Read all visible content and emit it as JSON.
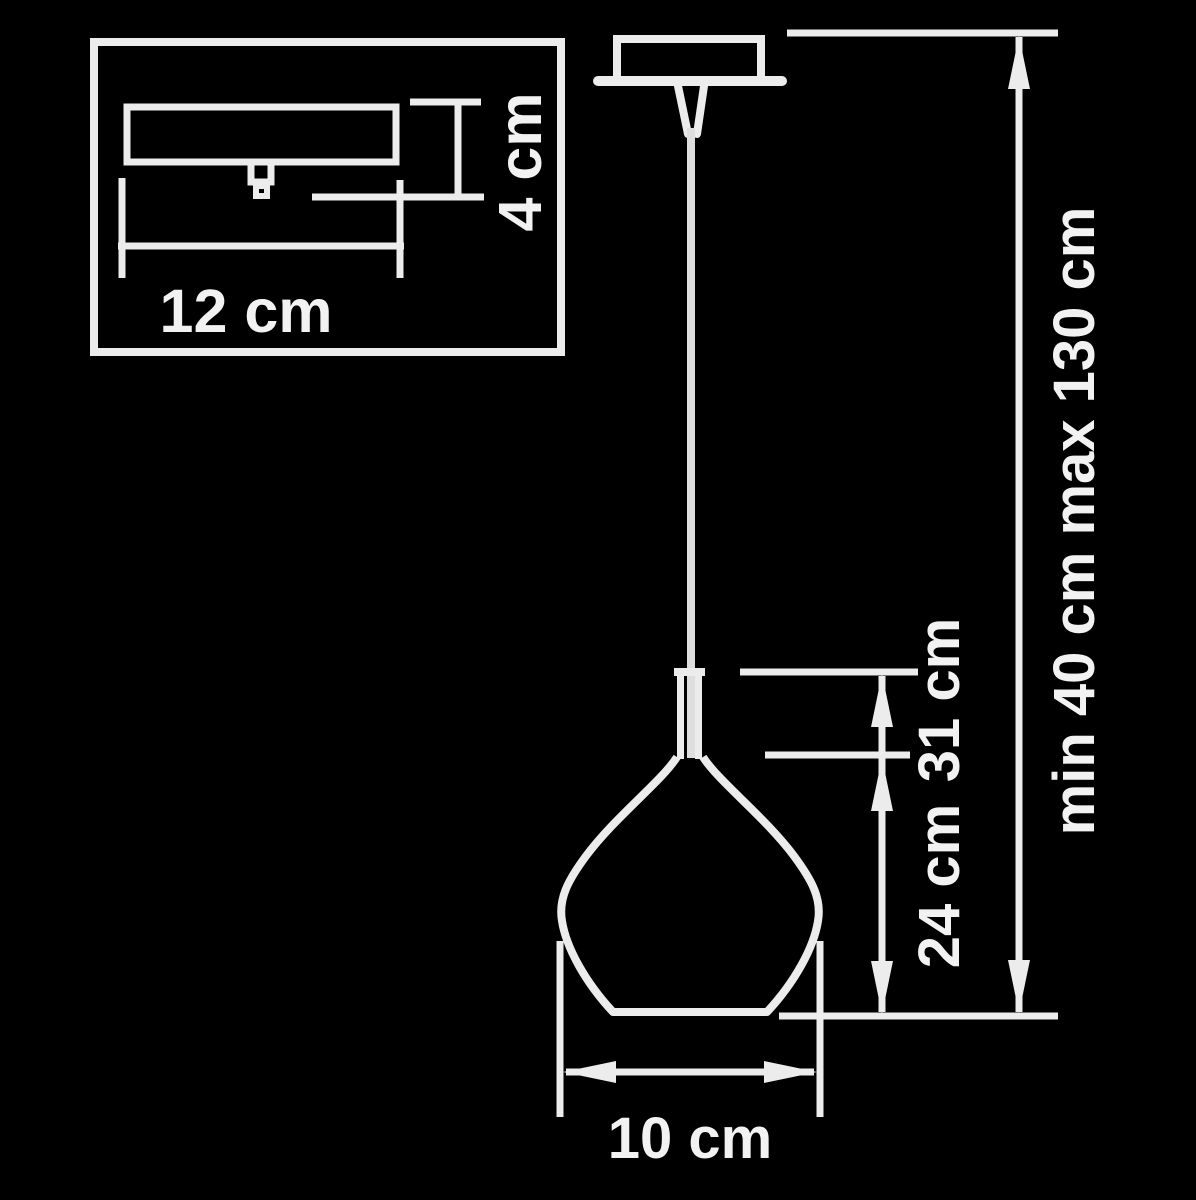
{
  "diagram": {
    "type": "pendant-lamp-dimension-drawing",
    "background_color": "#000000",
    "line_color": "#ececec",
    "text_color": "#f2f2f2",
    "labels": {
      "canopy_width": "12 cm",
      "canopy_height": "4 cm",
      "suspension_range": "min 40 cm max 130 cm",
      "shade_total_height": "31 cm",
      "shade_body_height": "24 cm",
      "shade_diameter": "10 cm"
    }
  }
}
